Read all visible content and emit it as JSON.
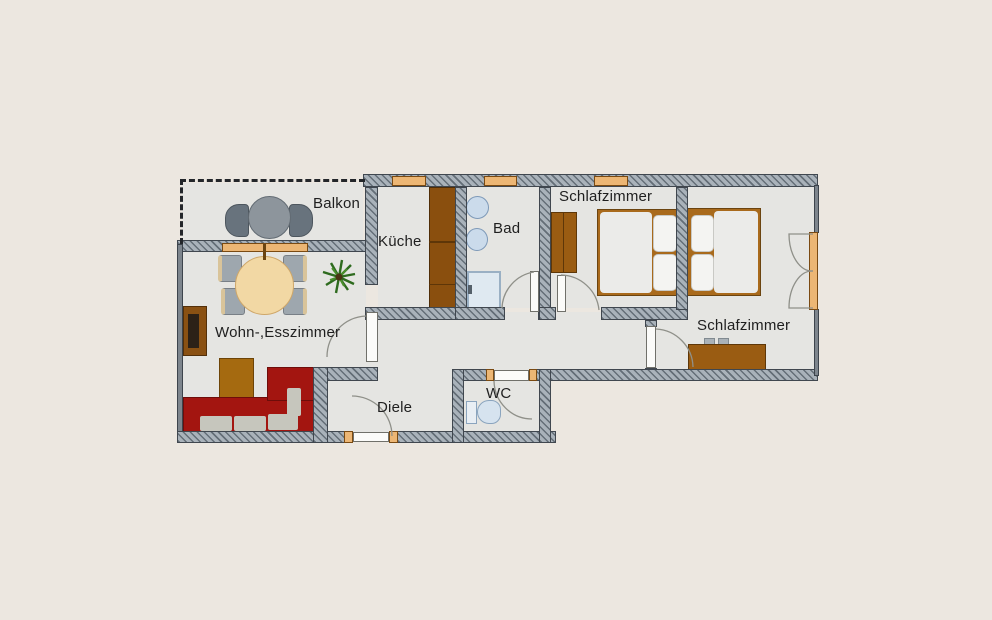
{
  "plan_type": "apartment-floor-plan",
  "rooms": {
    "balkon": {
      "label": "Balkon"
    },
    "kueche": {
      "label": "Küche"
    },
    "bad": {
      "label": "Bad"
    },
    "schlafzimmer1": {
      "label": "Schlafzimmer"
    },
    "schlafzimmer2": {
      "label": "Schlafzimmer"
    },
    "wohnesszimmer": {
      "label": "Wohn-,Esszimmer"
    },
    "diele": {
      "label": "Diele"
    },
    "wc": {
      "label": "WC"
    }
  },
  "colors": {
    "background": "#ece7e0",
    "floor": "#e5e5e2",
    "wall": "#a9b2ba",
    "wall_outline": "#40474f",
    "wood": "#9a5c12",
    "window_frame": "#ecb674",
    "sofa_red": "#a31510",
    "fixture_blue": "#cbdbeb",
    "table_wheat": "#f2d8a4",
    "plant_green": "#2e6b1e",
    "label_text": "#1f1f1f"
  },
  "furniture": {
    "balcony": [
      "round-table",
      "chair",
      "chair"
    ],
    "living_dining": [
      "dining-table",
      "chairs",
      "tv-unit",
      "coffee-table",
      "corner-sofa",
      "plant"
    ],
    "kitchen": [
      "cabinet-run"
    ],
    "bath": [
      "sink",
      "sink",
      "shower"
    ],
    "bedroom1": [
      "wardrobe",
      "double-bed"
    ],
    "bedroom2": [
      "double-bed",
      "sideboard"
    ],
    "wc": [
      "toilet"
    ]
  }
}
